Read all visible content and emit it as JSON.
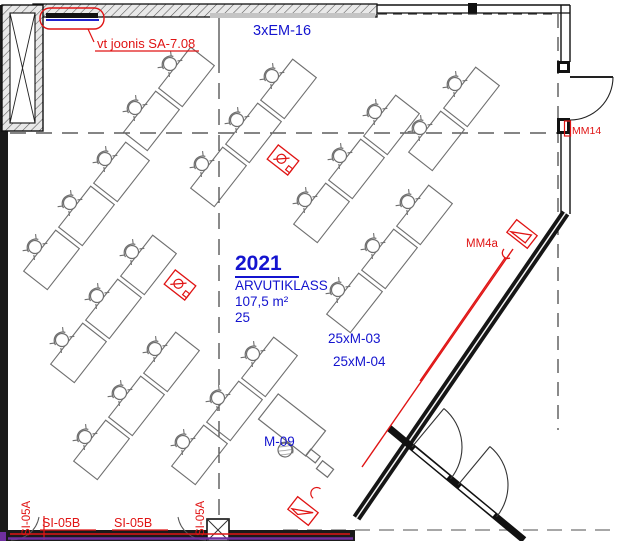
{
  "drawing": {
    "room": {
      "number": "2021",
      "name": "ARVUTIKLASS",
      "area": "107,5 m²",
      "seats": "25"
    },
    "labels": {
      "em_top": "3xEM-16",
      "revision_note": "vt joonis SA-7.08",
      "mm14": "MM14",
      "mm4a": "MM4a",
      "m03": "25xM-03",
      "m04": "25xM-04",
      "m09": "M-09",
      "si05b_1": "SI-05B",
      "si05b_2": "SI-05B",
      "si05a_1": "SI-05A",
      "si05a_2": "SI-05A"
    },
    "colors": {
      "annotation_blue": "#1414cf",
      "revision_red": "#e01414",
      "system_purple": "#7030a0",
      "wall_dark": "#141414",
      "furniture_gray": "#6f6f6f"
    },
    "furniture": {
      "desk_size": [
        52,
        30
      ],
      "row_rotation_deg": -52,
      "chairs": [
        [
          135,
          108
        ],
        [
          170,
          64
        ],
        [
          35,
          247
        ],
        [
          70,
          203
        ],
        [
          105,
          159
        ],
        [
          62,
          340
        ],
        [
          97,
          296
        ],
        [
          132,
          252
        ],
        [
          85,
          437
        ],
        [
          120,
          393
        ],
        [
          155,
          349
        ],
        [
          183,
          442
        ],
        [
          218,
          398
        ],
        [
          253,
          354
        ],
        [
          202,
          164
        ],
        [
          237,
          120
        ],
        [
          272,
          76
        ],
        [
          305,
          200
        ],
        [
          340,
          156
        ],
        [
          375,
          112
        ],
        [
          338,
          290
        ],
        [
          373,
          246
        ],
        [
          408,
          202
        ],
        [
          420,
          128
        ],
        [
          455,
          84
        ]
      ],
      "floor_boxes": [
        [
          180,
          285
        ],
        [
          283,
          160
        ]
      ]
    }
  }
}
